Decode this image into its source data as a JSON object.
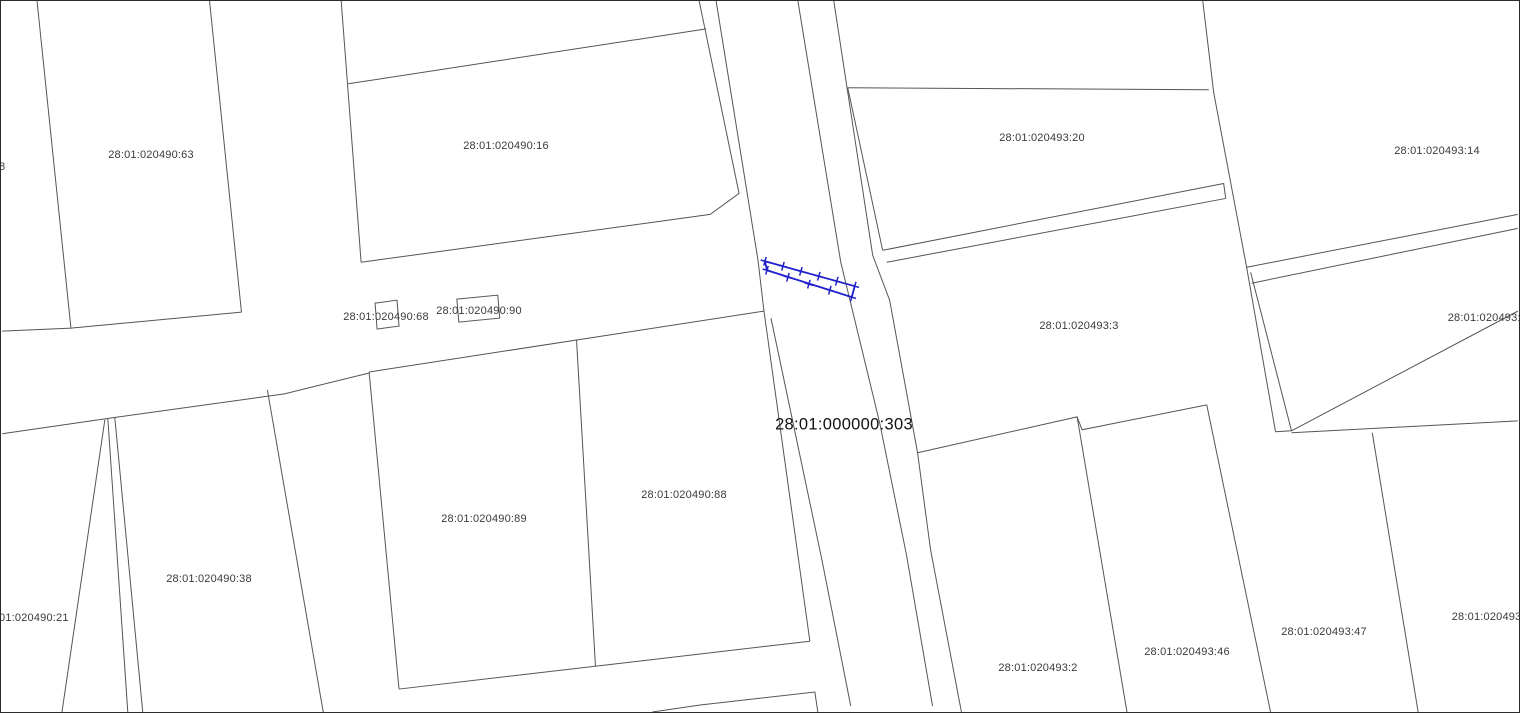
{
  "map": {
    "title": "cadastral parcel map",
    "selected_parcel": {
      "cadastral_number": "28:01:000000:303",
      "highlight_color": "#2121cb"
    },
    "colors": {
      "background": "#ffffff",
      "boundary_line": "#555555",
      "label_text": "#3a3a3a",
      "selected_label_text": "#111111",
      "frame": "#2b2b2b"
    },
    "labels": [
      {
        "text": "8",
        "x": -2,
        "y": 166,
        "anchor": "left",
        "note": "clipped at left edge"
      },
      {
        "text": "28:01:020490:63",
        "x": 150,
        "y": 154,
        "anchor": "center"
      },
      {
        "text": "28:01:020490:16",
        "x": 505,
        "y": 145,
        "anchor": "center"
      },
      {
        "text": "28:01:020493:20",
        "x": 1041,
        "y": 137,
        "anchor": "center"
      },
      {
        "text": "28:01:020493:14",
        "x": 1436,
        "y": 150,
        "anchor": "center"
      },
      {
        "text": "28:01:020490:68",
        "x": 385,
        "y": 316,
        "anchor": "center"
      },
      {
        "text": "28:01:020490:90",
        "x": 478,
        "y": 310,
        "anchor": "center"
      },
      {
        "text": "28:01:020493:3",
        "x": 1078,
        "y": 325,
        "anchor": "center"
      },
      {
        "text": "28:01:020493:8",
        "x": 1526,
        "y": 317,
        "anchor": "right",
        "note": "clipped at right edge"
      },
      {
        "text": "28:01:000000:303",
        "x": 843,
        "y": 424,
        "anchor": "center",
        "emphasis": true
      },
      {
        "text": "28:01:020490:38",
        "x": 208,
        "y": 578,
        "anchor": "center"
      },
      {
        "text": "01:020490:21",
        "x": -2,
        "y": 617,
        "anchor": "left",
        "note": "clipped at left edge"
      },
      {
        "text": "28:01:020490:89",
        "x": 483,
        "y": 518,
        "anchor": "center"
      },
      {
        "text": "28:01:020490:88",
        "x": 683,
        "y": 494,
        "anchor": "center"
      },
      {
        "text": "28:01:020493:2",
        "x": 1037,
        "y": 667,
        "anchor": "center"
      },
      {
        "text": "28:01:020493:46",
        "x": 1186,
        "y": 651,
        "anchor": "center"
      },
      {
        "text": "28:01:020493:47",
        "x": 1323,
        "y": 631,
        "anchor": "center"
      },
      {
        "text": "28:01:020493:3",
        "x": 1530,
        "y": 616,
        "anchor": "right",
        "note": "clipped at right edge"
      }
    ]
  }
}
